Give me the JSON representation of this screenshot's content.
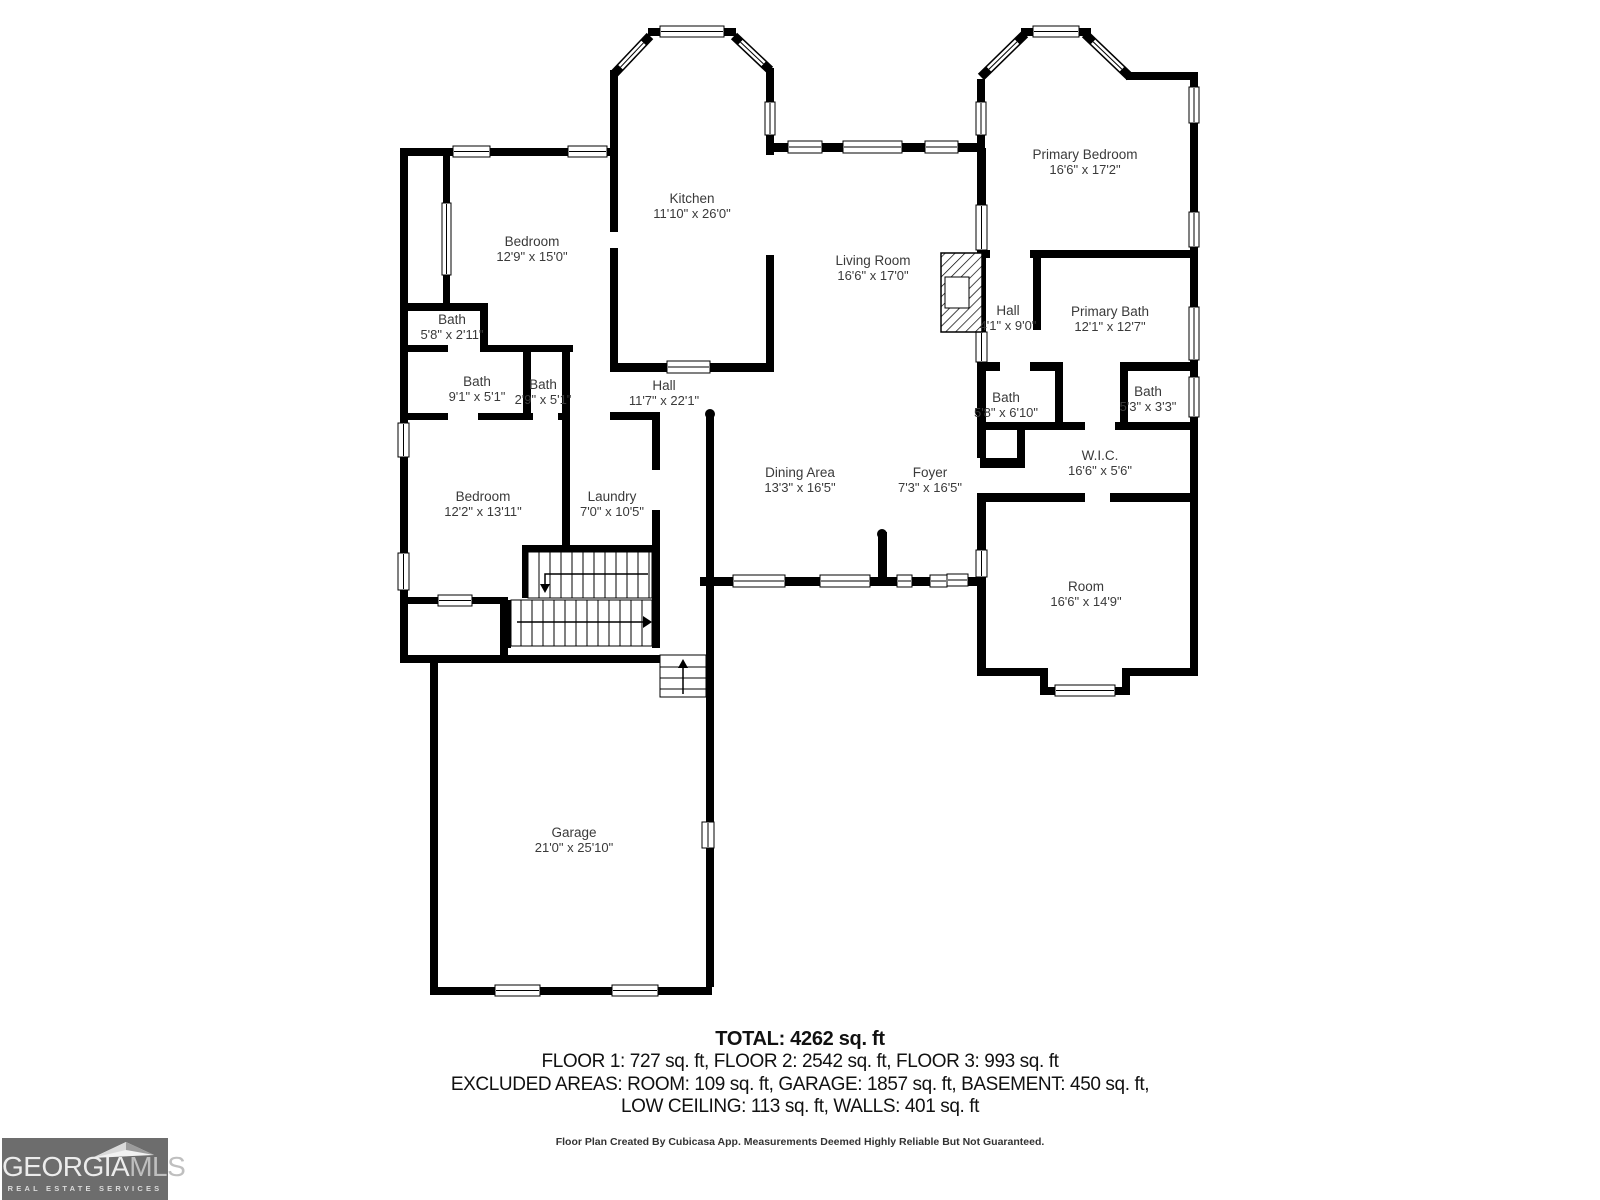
{
  "rooms": [
    {
      "name": "Kitchen",
      "dims": "11'10\" x 26'0\""
    },
    {
      "name": "Bedroom",
      "dims": "12'9\" x 15'0\""
    },
    {
      "name": "Primary Bedroom",
      "dims": "16'6\" x 17'2\""
    },
    {
      "name": "Living Room",
      "dims": "16'6\" x 17'0\""
    },
    {
      "name": "Hall",
      "dims": "4'1\" x 9'0\""
    },
    {
      "name": "Primary Bath",
      "dims": "12'1\" x 12'7\""
    },
    {
      "name": "Bath",
      "dims": "5'8\" x 2'11\""
    },
    {
      "name": "Bath",
      "dims": "9'1\" x 5'1\""
    },
    {
      "name": "Bath",
      "dims": "2'9\" x 5'1\""
    },
    {
      "name": "Hall",
      "dims": "11'7\" x 22'1\""
    },
    {
      "name": "Bath",
      "dims": "5'8\" x 6'10\""
    },
    {
      "name": "Bath",
      "dims": "5'3\" x 3'3\""
    },
    {
      "name": "W.I.C.",
      "dims": "16'6\" x 5'6\""
    },
    {
      "name": "Dining Area",
      "dims": "13'3\" x 16'5\""
    },
    {
      "name": "Foyer",
      "dims": "7'3\" x 16'5\""
    },
    {
      "name": "Bedroom",
      "dims": "12'2\" x 13'11\""
    },
    {
      "name": "Laundry",
      "dims": "7'0\" x 10'5\""
    },
    {
      "name": "Room",
      "dims": "16'6\" x 14'9\""
    },
    {
      "name": "Garage",
      "dims": "21'0\" x 25'10\""
    }
  ],
  "summary": {
    "total": "TOTAL: 4262 sq. ft",
    "floors": "FLOOR 1: 727 sq. ft, FLOOR 2: 2542 sq. ft, FLOOR 3: 993 sq. ft",
    "excluded1": "EXCLUDED AREAS: ROOM: 109 sq. ft, GARAGE: 1857 sq. ft, BASEMENT: 450 sq. ft,",
    "excluded2": "LOW CEILING: 113 sq. ft, WALLS: 401 sq. ft"
  },
  "disclaimer": "Floor Plan Created By Cubicasa App. Measurements Deemed Highly Reliable But Not Guaranteed.",
  "logo": {
    "brand_primary": "GEORGIA",
    "brand_secondary": "MLS",
    "tagline": "REAL ESTATE SERVICES"
  },
  "colors": {
    "wall": "#000000",
    "background": "#ffffff",
    "label_text": "#3a3a3a",
    "logo_background": "#6d6d6d",
    "logo_text": "#ececec"
  }
}
